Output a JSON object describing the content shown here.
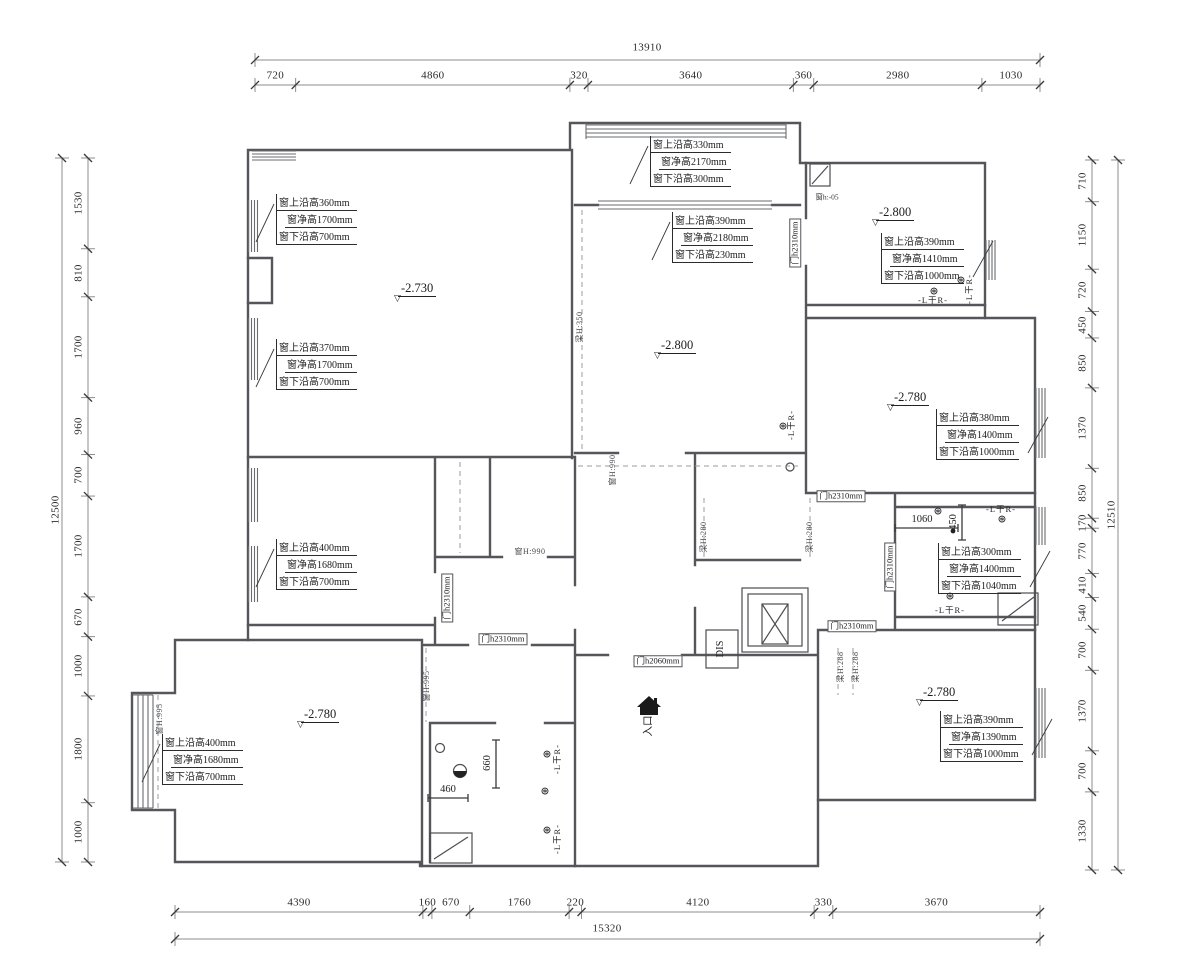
{
  "dims": {
    "top": {
      "total": "13910",
      "segments": [
        "720",
        "4860",
        "320",
        "3640",
        "360",
        "2980",
        "1030"
      ]
    },
    "bottom": {
      "total": "15320",
      "segments": [
        "4390",
        "160",
        "670",
        "1760",
        "220",
        "4120",
        "330",
        "3670"
      ]
    },
    "left": {
      "total": "12500",
      "segments": [
        "1530",
        "810",
        "1700",
        "960",
        "700",
        "1700",
        "670",
        "1000",
        "1800",
        "1000"
      ]
    },
    "right": {
      "total": "12510",
      "segments": [
        "710",
        "1150",
        "720",
        "450",
        "850",
        "1370",
        "850",
        "170",
        "770",
        "410",
        "540",
        "700",
        "1370",
        "700",
        "1330"
      ]
    }
  },
  "elevations": [
    {
      "value": "-2.730"
    },
    {
      "value": "-2.800"
    },
    {
      "value": "-2.800"
    },
    {
      "value": "-2.780"
    },
    {
      "value": "-2.780"
    },
    {
      "value": "-2.780"
    }
  ],
  "window_notes": [
    {
      "lines": [
        "窗上沿高360mm",
        "窗净高1700mm",
        "窗下沿高700mm"
      ]
    },
    {
      "lines": [
        "窗上沿高370mm",
        "窗净高1700mm",
        "窗下沿高700mm"
      ]
    },
    {
      "lines": [
        "窗上沿高330mm",
        "窗净高2170mm",
        "窗下沿高300mm"
      ]
    },
    {
      "lines": [
        "窗上沿高390mm",
        "窗净高2180mm",
        "窗下沿高230mm"
      ]
    },
    {
      "lines": [
        "窗上沿高390mm",
        "窗净高1410mm",
        "窗下沿高1000mm"
      ]
    },
    {
      "lines": [
        "窗上沿高380mm",
        "窗净高1400mm",
        "窗下沿高1000mm"
      ]
    },
    {
      "lines": [
        "窗上沿高300mm",
        "窗净高1400mm",
        "窗下沿高1040mm"
      ]
    },
    {
      "lines": [
        "窗上沿高400mm",
        "窗净高1680mm",
        "窗下沿高700mm"
      ]
    },
    {
      "lines": [
        "窗上沿高400mm",
        "窗净高1680mm",
        "窗下沿高700mm"
      ]
    },
    {
      "lines": [
        "窗上沿高390mm",
        "窗净高1390mm",
        "窗下沿高1000mm"
      ]
    }
  ],
  "door_labels": [
    "门h2310mm",
    "门h2310mm",
    "门h2060mm",
    "门h2310mm",
    "门h2310mm",
    "门h2310mm",
    "门h2310mm"
  ],
  "beam_labels": [
    "梁H:350",
    "窗H:990",
    "窗H:990",
    "梁H:280",
    "梁H:280",
    "梁H:288",
    "梁H:288",
    "窗H:995",
    "窗H:995"
  ],
  "misc": {
    "entry": "入口",
    "dis": "DIS",
    "win_small": "窗h:-05",
    "radiator": "-L干R-",
    "radiator_icon": "⊛",
    "elev_icon": "▽",
    "dim_1060": "1060",
    "dim_450": "450",
    "dim_460": "460",
    "dim_660": "660"
  }
}
